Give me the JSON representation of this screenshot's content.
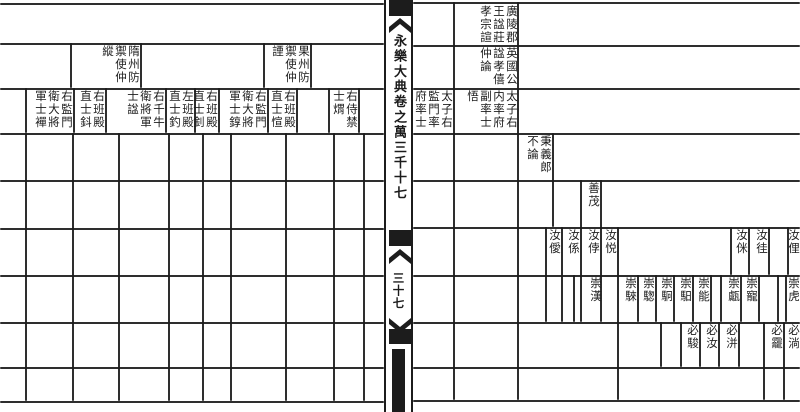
{
  "colors": {
    "ink": "#1c1c1c",
    "paper": "#ffffff"
  },
  "spine": {
    "title": "永樂大典卷之萬三千十七",
    "folio": "三十七"
  },
  "left_page": {
    "h_lines": [
      {
        "y": 3,
        "x1": 0,
        "x2": 384
      },
      {
        "y": 43,
        "x1": 0,
        "x2": 384
      },
      {
        "y": 88,
        "x1": 0,
        "x2": 384
      },
      {
        "y": 133,
        "x1": 0,
        "x2": 384
      },
      {
        "y": 180,
        "x1": 0,
        "x2": 384
      },
      {
        "y": 228,
        "x1": 0,
        "x2": 384
      },
      {
        "y": 275,
        "x1": 0,
        "x2": 384
      },
      {
        "y": 322,
        "x1": 0,
        "x2": 384
      },
      {
        "y": 367,
        "x1": 0,
        "x2": 384
      },
      {
        "y": 401,
        "x1": 0,
        "x2": 384
      }
    ],
    "v_lines": [
      {
        "x": 70,
        "y1": 43,
        "y2": 88
      },
      {
        "x": 140,
        "y1": 43,
        "y2": 88
      },
      {
        "x": 263,
        "y1": 43,
        "y2": 88
      },
      {
        "x": 310,
        "y1": 43,
        "y2": 88
      },
      {
        "x": 25,
        "y1": 88,
        "y2": 133
      },
      {
        "x": 73,
        "y1": 88,
        "y2": 133
      },
      {
        "x": 105,
        "y1": 88,
        "y2": 133
      },
      {
        "x": 165,
        "y1": 88,
        "y2": 133
      },
      {
        "x": 194,
        "y1": 88,
        "y2": 133
      },
      {
        "x": 218,
        "y1": 88,
        "y2": 133
      },
      {
        "x": 267,
        "y1": 88,
        "y2": 133
      },
      {
        "x": 296,
        "y1": 88,
        "y2": 133
      },
      {
        "x": 328,
        "y1": 88,
        "y2": 133
      },
      {
        "x": 358,
        "y1": 88,
        "y2": 133
      },
      {
        "x": 25,
        "y1": 133,
        "y2": 401
      },
      {
        "x": 72,
        "y1": 133,
        "y2": 401
      },
      {
        "x": 118,
        "y1": 133,
        "y2": 401
      },
      {
        "x": 168,
        "y1": 133,
        "y2": 401
      },
      {
        "x": 202,
        "y1": 133,
        "y2": 401
      },
      {
        "x": 230,
        "y1": 133,
        "y2": 401
      },
      {
        "x": 285,
        "y1": 133,
        "y2": 401
      },
      {
        "x": 333,
        "y1": 133,
        "y2": 401
      },
      {
        "x": 363,
        "y1": 133,
        "y2": 401
      }
    ],
    "cells": [
      {
        "x": 70,
        "y": 45,
        "w": 70,
        "h": 43,
        "text": "隋州防禦使仲縱"
      },
      {
        "x": 263,
        "y": 45,
        "w": 47,
        "h": 43,
        "text": "果州防禦使仲諲"
      },
      {
        "x": 328,
        "y": 90,
        "w": 30,
        "h": 43,
        "text": "右侍禁士煟"
      },
      {
        "x": 267,
        "y": 90,
        "w": 29,
        "h": 43,
        "text": "右班殿直士愃"
      },
      {
        "x": 218,
        "y": 90,
        "w": 49,
        "h": 43,
        "text": "右監門衛大將軍士錞"
      },
      {
        "x": 194,
        "y": 90,
        "w": 24,
        "h": 43,
        "text": "右班殿直士釗"
      },
      {
        "x": 165,
        "y": 90,
        "w": 29,
        "h": 43,
        "text": "左班殿直士釣"
      },
      {
        "x": 105,
        "y": 90,
        "w": 60,
        "h": 43,
        "text": "右千牛衛將軍士諡"
      },
      {
        "x": 73,
        "y": 90,
        "w": 32,
        "h": 43,
        "text": "右班殿直士鈄"
      },
      {
        "x": 25,
        "y": 90,
        "w": 48,
        "h": 43,
        "text": "右監門衛大將軍士襌"
      }
    ]
  },
  "right_page": {
    "h_lines": [
      {
        "y": 2,
        "x1": 413,
        "x2": 800
      },
      {
        "y": 45,
        "x1": 413,
        "x2": 800
      },
      {
        "y": 88,
        "x1": 413,
        "x2": 800
      },
      {
        "y": 133,
        "x1": 413,
        "x2": 800
      },
      {
        "y": 180,
        "x1": 413,
        "x2": 800
      },
      {
        "y": 227,
        "x1": 413,
        "x2": 800
      },
      {
        "y": 275,
        "x1": 413,
        "x2": 800
      },
      {
        "y": 322,
        "x1": 413,
        "x2": 800
      },
      {
        "y": 367,
        "x1": 413,
        "x2": 800
      },
      {
        "y": 400,
        "x1": 413,
        "x2": 800
      }
    ],
    "v_lines": [
      {
        "x": 453,
        "y1": 2,
        "y2": 400
      },
      {
        "x": 517,
        "y1": 2,
        "y2": 400
      },
      {
        "x": 552,
        "y1": 133,
        "y2": 227
      },
      {
        "x": 545,
        "y1": 227,
        "y2": 322
      },
      {
        "x": 561,
        "y1": 227,
        "y2": 322
      },
      {
        "x": 573,
        "y1": 275,
        "y2": 322
      },
      {
        "x": 580,
        "y1": 180,
        "y2": 322
      },
      {
        "x": 600,
        "y1": 180,
        "y2": 322
      },
      {
        "x": 617,
        "y1": 227,
        "y2": 400
      },
      {
        "x": 730,
        "y1": 227,
        "y2": 275
      },
      {
        "x": 748,
        "y1": 227,
        "y2": 275
      },
      {
        "x": 768,
        "y1": 227,
        "y2": 275
      },
      {
        "x": 787,
        "y1": 227,
        "y2": 275
      },
      {
        "x": 637,
        "y1": 275,
        "y2": 322
      },
      {
        "x": 655,
        "y1": 275,
        "y2": 322
      },
      {
        "x": 673,
        "y1": 275,
        "y2": 322
      },
      {
        "x": 692,
        "y1": 275,
        "y2": 322
      },
      {
        "x": 710,
        "y1": 275,
        "y2": 322
      },
      {
        "x": 720,
        "y1": 275,
        "y2": 322
      },
      {
        "x": 740,
        "y1": 275,
        "y2": 322
      },
      {
        "x": 758,
        "y1": 275,
        "y2": 322
      },
      {
        "x": 777,
        "y1": 275,
        "y2": 322
      },
      {
        "x": 785,
        "y1": 275,
        "y2": 322
      },
      {
        "x": 660,
        "y1": 322,
        "y2": 367
      },
      {
        "x": 680,
        "y1": 322,
        "y2": 367
      },
      {
        "x": 699,
        "y1": 322,
        "y2": 367
      },
      {
        "x": 718,
        "y1": 322,
        "y2": 367
      },
      {
        "x": 738,
        "y1": 322,
        "y2": 367
      },
      {
        "x": 763,
        "y1": 322,
        "y2": 400
      },
      {
        "x": 783,
        "y1": 322,
        "y2": 400
      }
    ],
    "cells": [
      {
        "x": 454,
        "y": 5,
        "w": 64,
        "h": 40,
        "text": "廣陵郡王諡莊孝宗諠"
      },
      {
        "x": 454,
        "y": 47,
        "w": 64,
        "h": 41,
        "text": "英國公諡孝僖仲論"
      },
      {
        "x": 414,
        "y": 90,
        "w": 39,
        "h": 43,
        "text": "太子右監門率府率士"
      },
      {
        "x": 454,
        "y": 90,
        "w": 64,
        "h": 43,
        "text": "太子右内率府副率士悟"
      },
      {
        "x": 517,
        "y": 135,
        "w": 35,
        "h": 45,
        "text": "秉義郎不論"
      },
      {
        "x": 580,
        "y": 182,
        "w": 20,
        "h": 45,
        "text": "善茂"
      },
      {
        "x": 545,
        "y": 229,
        "w": 16,
        "h": 46,
        "text": "汝僾"
      },
      {
        "x": 561,
        "y": 229,
        "w": 19,
        "h": 46,
        "text": "汝係"
      },
      {
        "x": 580,
        "y": 229,
        "w": 20,
        "h": 46,
        "text": "汝侼"
      },
      {
        "x": 600,
        "y": 229,
        "w": 17,
        "h": 46,
        "text": "汝悦"
      },
      {
        "x": 730,
        "y": 229,
        "w": 18,
        "h": 46,
        "text": "汝侎"
      },
      {
        "x": 748,
        "y": 229,
        "w": 20,
        "h": 46,
        "text": "汝徍"
      },
      {
        "x": 787,
        "y": 229,
        "w": 13,
        "h": 46,
        "text": "汝俚"
      },
      {
        "x": 580,
        "y": 277,
        "w": 22,
        "h": 45,
        "text": "崇漢"
      },
      {
        "x": 617,
        "y": 277,
        "w": 20,
        "h": 45,
        "text": "崇騋"
      },
      {
        "x": 637,
        "y": 277,
        "w": 18,
        "h": 45,
        "text": "崇騘"
      },
      {
        "x": 655,
        "y": 277,
        "w": 18,
        "h": 45,
        "text": "崇駉"
      },
      {
        "x": 673,
        "y": 277,
        "w": 19,
        "h": 45,
        "text": "崇馹"
      },
      {
        "x": 692,
        "y": 277,
        "w": 18,
        "h": 45,
        "text": "崇能"
      },
      {
        "x": 720,
        "y": 277,
        "w": 20,
        "h": 45,
        "text": "崇甗"
      },
      {
        "x": 740,
        "y": 277,
        "w": 18,
        "h": 45,
        "text": "崇寵"
      },
      {
        "x": 785,
        "y": 277,
        "w": 15,
        "h": 45,
        "text": "崇虎"
      },
      {
        "x": 680,
        "y": 324,
        "w": 19,
        "h": 42,
        "text": "必駿"
      },
      {
        "x": 699,
        "y": 324,
        "w": 19,
        "h": 42,
        "text": "必汝"
      },
      {
        "x": 718,
        "y": 324,
        "w": 20,
        "h": 42,
        "text": "必洴"
      },
      {
        "x": 763,
        "y": 324,
        "w": 20,
        "h": 42,
        "text": "必靇"
      },
      {
        "x": 783,
        "y": 324,
        "w": 17,
        "h": 42,
        "text": "必淌"
      }
    ]
  }
}
